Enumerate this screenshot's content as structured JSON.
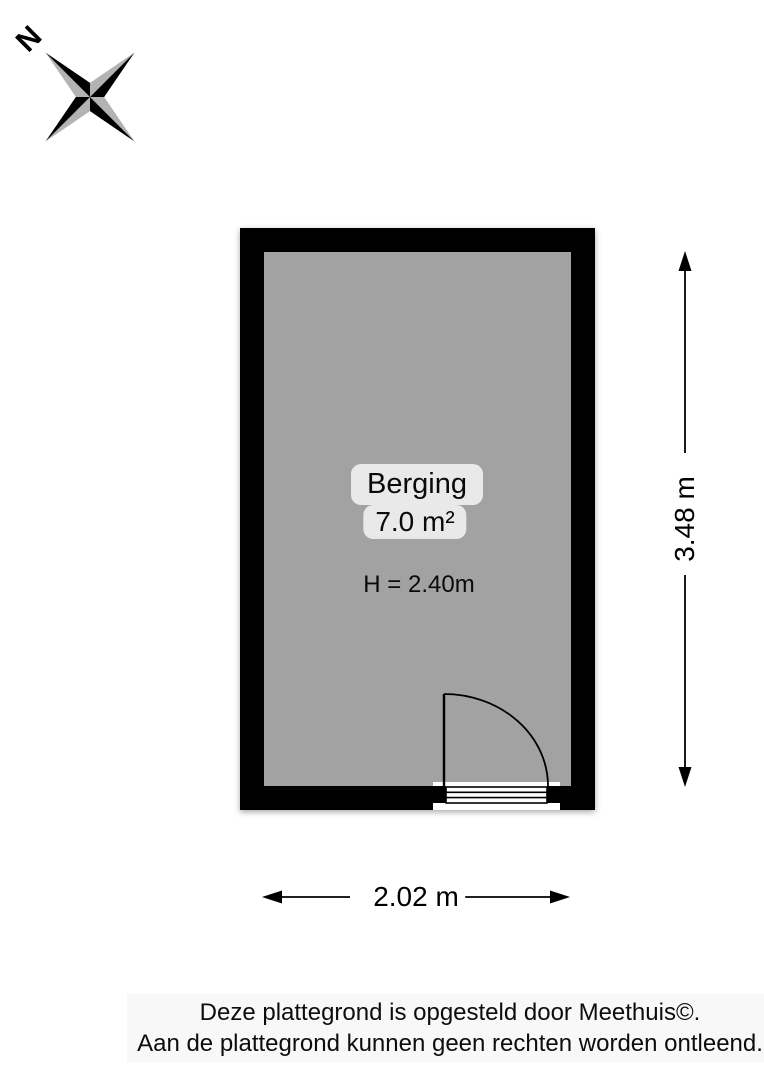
{
  "compass": {
    "north_label": "N"
  },
  "room": {
    "name": "Berging",
    "area": "7.0 m²",
    "ceiling_height": "H = 2.40m"
  },
  "dimensions": {
    "height_label": "3.48 m",
    "width_label": "2.02 m"
  },
  "footer": {
    "line1": "Deze plattegrond is opgesteld door Meethuis©.",
    "line2": "Aan de plattegrond kunnen geen rechten worden ontleend."
  },
  "colors": {
    "wall": "#000000",
    "floor": "#a2a2a2",
    "label_pill": "#e9e9e9",
    "compass_gray": "#b3b3b3"
  }
}
